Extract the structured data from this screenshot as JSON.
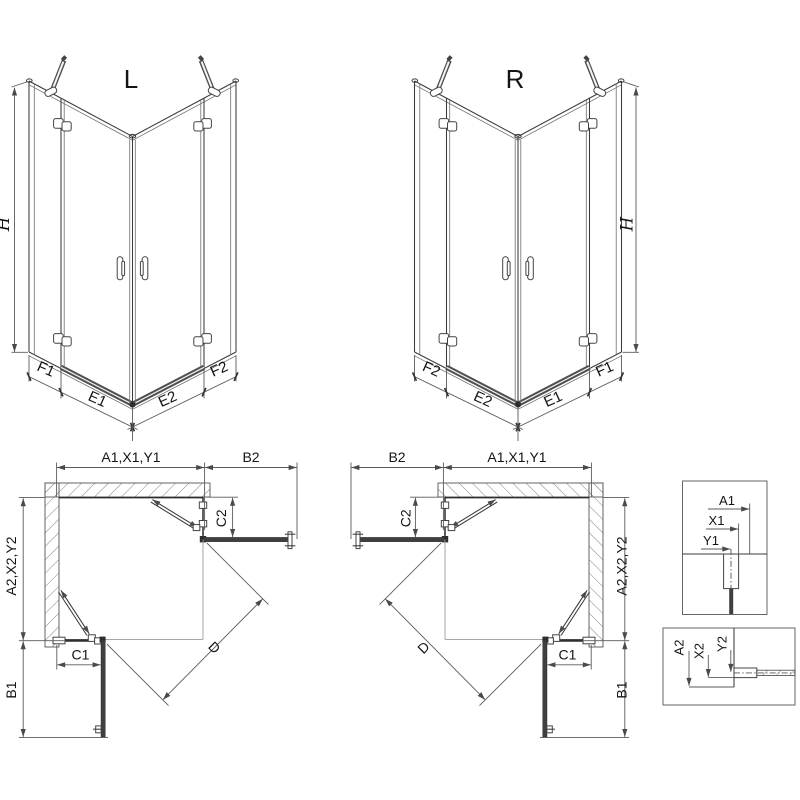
{
  "drawing": {
    "colors": {
      "line": "#3a3a3a",
      "dim": "#5a5a5a",
      "text": "#141414",
      "panel": "#3f3f3f",
      "tray": "#4f4f4f",
      "hatch": "#757575",
      "light": "#9a9a9a"
    },
    "view_l": {
      "title": "L",
      "height_label": "H",
      "widths": {
        "f1": "F1",
        "e1": "E1",
        "e2": "E2",
        "f2": "F2"
      }
    },
    "view_r": {
      "title": "R",
      "height_label": "H",
      "widths": {
        "f1": "F1",
        "e1": "E1",
        "e2": "E2",
        "f2": "F2"
      }
    },
    "plan_l": {
      "top_width": "A1,X1,Y1",
      "return_panel_top": "B2",
      "door_top": "C2",
      "side_depth": "A2,X2,Y2",
      "return_panel_side": "B1",
      "door_side": "C1",
      "diagonal": "D"
    },
    "plan_r": {
      "top_width": "A1,X1,Y1",
      "return_panel_top": "B2",
      "door_top": "C2",
      "side_depth": "A2,X2,Y2",
      "return_panel_side": "B1",
      "door_side": "C1",
      "diagonal": "D"
    },
    "inset_top": {
      "a1": "A1",
      "x1": "X1",
      "y1": "Y1"
    },
    "inset_bottom": {
      "a2": "A2",
      "x2": "X2",
      "y2": "Y2"
    }
  }
}
